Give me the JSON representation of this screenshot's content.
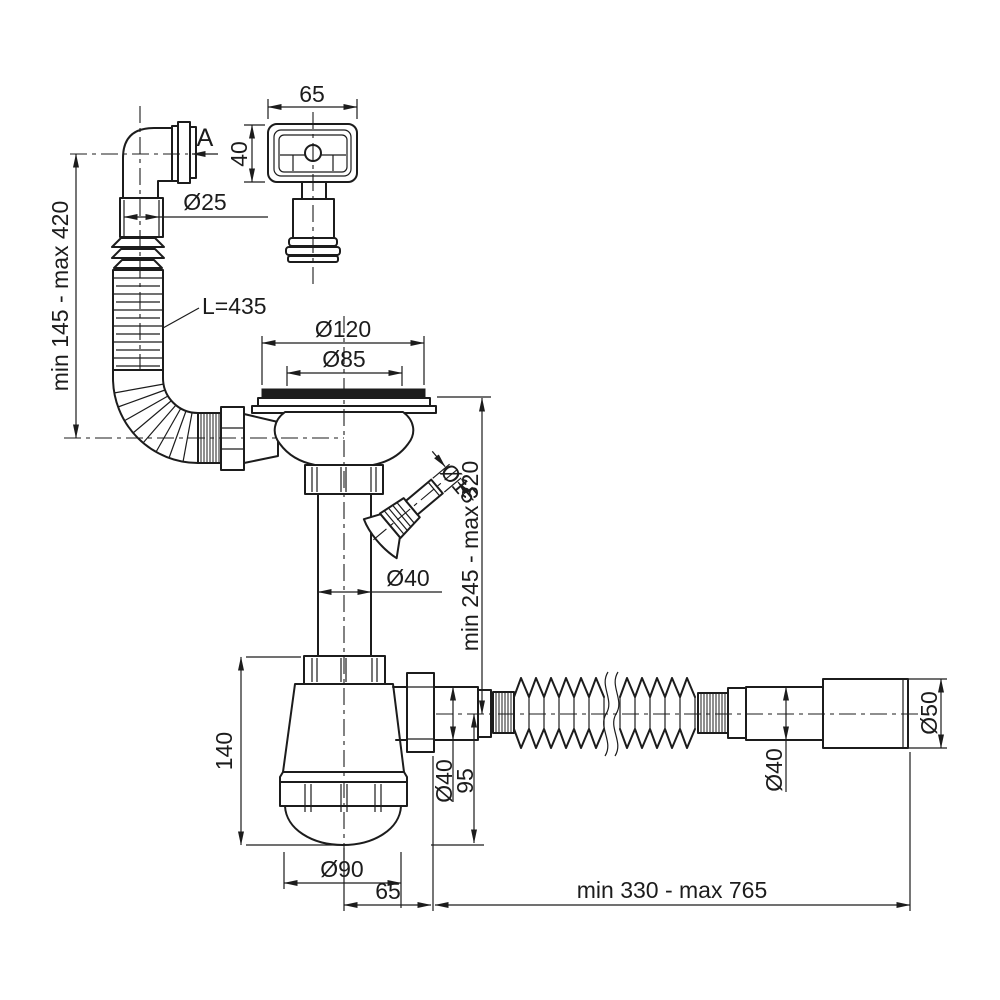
{
  "labels": {
    "view_a": "A",
    "d25": "Ø25",
    "vertical_range_left": "min 145 - max 420",
    "hose_length": "L=435",
    "overflow_width": "65",
    "overflow_height": "40",
    "d120": "Ø120",
    "d85": "Ø85",
    "d15": "Ø15",
    "d40_tailpipe": "Ø40",
    "vertical_range_right": "min 245 - max 320",
    "trap_height": "140",
    "d40_outlet": "Ø40",
    "outlet_drop": "95",
    "d90": "Ø90",
    "trap_offset": "65",
    "horizontal_range": "min 330 - max 765",
    "d40_flex": "Ø40",
    "d50": "Ø50"
  },
  "colors": {
    "line": "#1c1c1c",
    "background": "#ffffff"
  }
}
